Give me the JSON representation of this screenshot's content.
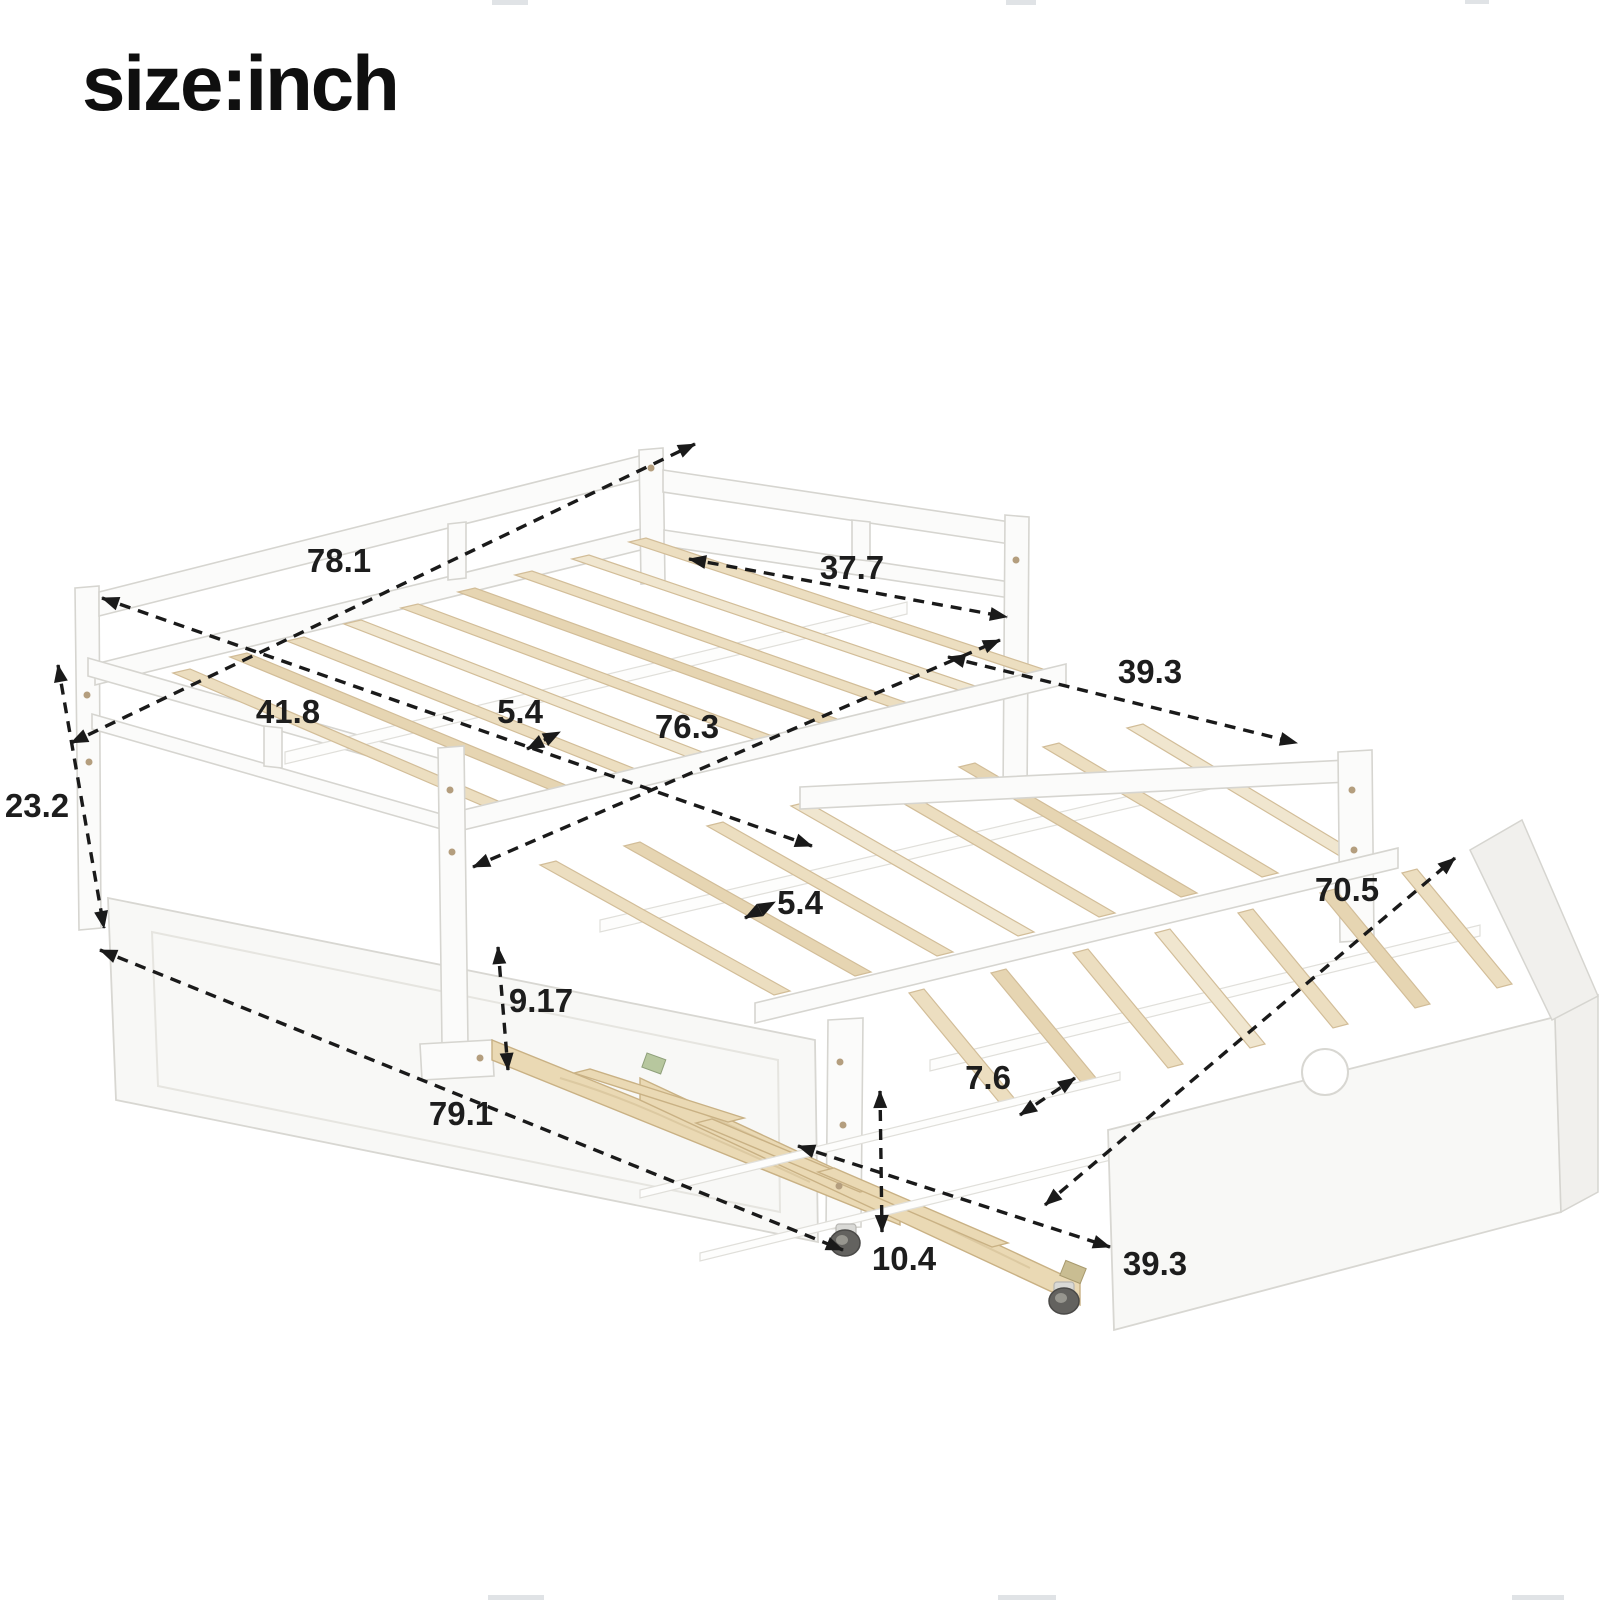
{
  "title": "size:inch",
  "unit": "inch",
  "colors": {
    "background": "#ffffff",
    "title_text": "#0f0f0f",
    "dimension_line": "#1a1a1a",
    "dimension_text": "#1d1d1d",
    "frame_white": "#fbfbfa",
    "frame_stroke": "#d6d5d0",
    "slat_wood": "#ecdec0",
    "slat_stroke": "#d2bd98",
    "pine_wood": "#ead9b4",
    "caster_wheel": "#63625f"
  },
  "dimensions": [
    {
      "name": "daybed-top-length",
      "value": "78.1",
      "line": [
        71,
        743,
        695,
        444
      ],
      "label": [
        339,
        561
      ]
    },
    {
      "name": "daybed-inner-width",
      "value": "37.7",
      "line": [
        689,
        559,
        1007,
        617
      ],
      "label": [
        852,
        568
      ]
    },
    {
      "name": "daybed-side-width",
      "value": "41.8",
      "line": [
        102,
        598,
        812,
        846
      ],
      "label": [
        288,
        712
      ]
    },
    {
      "name": "extension-width",
      "value": "39.3",
      "line": [
        948,
        657,
        1297,
        743
      ],
      "label": [
        1150,
        672
      ]
    },
    {
      "name": "slat-gap-upper",
      "value": "5.4",
      "line": [
        527,
        749,
        560,
        732
      ],
      "label": [
        520,
        712
      ]
    },
    {
      "name": "slat-length",
      "value": "76.3",
      "line": [
        473,
        867,
        1000,
        640
      ],
      "label": [
        687,
        727
      ]
    },
    {
      "name": "daybed-height",
      "value": "23.2",
      "line": [
        58,
        665,
        104,
        928
      ],
      "label": [
        37,
        806
      ]
    },
    {
      "name": "slat-gap-lower",
      "value": "5.4",
      "line": [
        745,
        918,
        775,
        902
      ],
      "label": [
        800,
        903
      ]
    },
    {
      "name": "trundle-slat-length",
      "value": "70.5",
      "line": [
        1045,
        1205,
        1455,
        858
      ],
      "label": [
        1347,
        890
      ]
    },
    {
      "name": "under-clearance-height",
      "value": "9.17",
      "line": [
        498,
        947,
        508,
        1070
      ],
      "label": [
        541,
        1001
      ]
    },
    {
      "name": "total-length",
      "value": "79.1",
      "line": [
        100,
        950,
        843,
        1250
      ],
      "label": [
        461,
        1114
      ]
    },
    {
      "name": "trundle-slat-gap",
      "value": "7.6",
      "line": [
        1020,
        1115,
        1075,
        1078
      ],
      "label": [
        988,
        1078
      ]
    },
    {
      "name": "trundle-height",
      "value": "10.4",
      "line": [
        880,
        1091,
        882,
        1232
      ],
      "label": [
        904,
        1259
      ]
    },
    {
      "name": "trundle-width",
      "value": "39.3",
      "line": [
        798,
        1146,
        1110,
        1247
      ],
      "label": [
        1155,
        1264
      ]
    }
  ]
}
